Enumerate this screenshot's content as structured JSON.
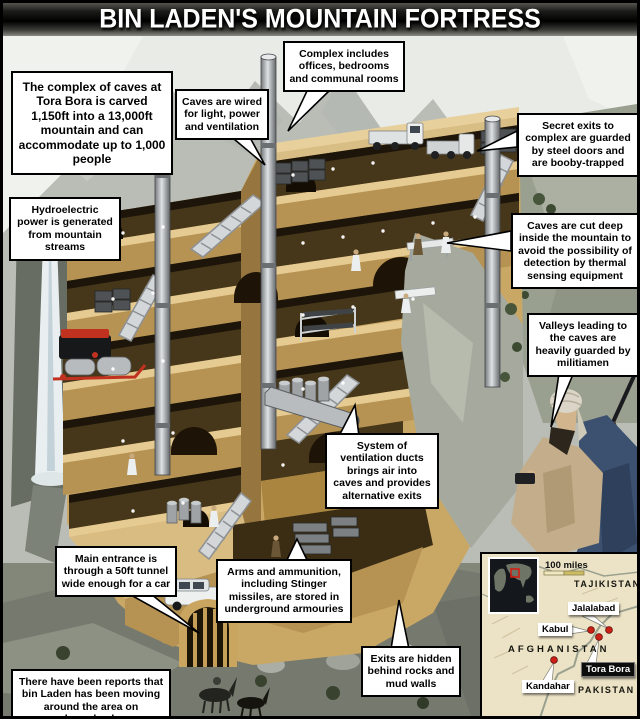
{
  "title": "BIN LADEN'S MOUNTAIN FORTRESS",
  "callouts": {
    "complex": "The complex of caves at Tora Bora is carved 1,150ft into a 13,000ft mountain and can accommodate up to 1,000 people",
    "wired": "Caves are wired for light, power and ventilation",
    "includes": "Complex includes offices, bedrooms and communal rooms",
    "secret_exits": "Secret exits to complex are guarded by steel doors and are booby-trapped",
    "hydro": "Hydroelectric power is generated from mountain streams",
    "cut_deep": "Caves are cut deep inside the mountain to avoid the possibility of detection by thermal sensing equipment",
    "valleys": "Valleys leading to the caves are heavily guarded by militiamen",
    "ventilation": "System of ventilation ducts brings air into caves and provides alternative exits",
    "main_entrance": "Main entrance is through a 50ft tunnel wide enough for a car",
    "arms": "Arms and ammunition, including Stinger missiles, are stored in underground armouries",
    "horseback": "There have been reports that bin Laden has been moving around the area on horseback",
    "exits_hidden": "Exits are hidden behind rocks and mud walls"
  },
  "map": {
    "scale_label": "100 miles",
    "countries": [
      "TAJIKISTAN",
      "AFGHANISTAN",
      "PAKISTAN"
    ],
    "cities": [
      "Jalalabad",
      "Kabul",
      "Kandahar"
    ],
    "highlight": "Tora Bora"
  },
  "colors": {
    "title_bg": "#000000",
    "callout_bg": "#ffffff",
    "cave_tan": "#c9a765",
    "cave_interior": "#46371b",
    "marker_red": "#cc2016",
    "cloak_blue": "#3c5170",
    "map_land": "#ece3c6",
    "generator_red": "#c0321f"
  }
}
